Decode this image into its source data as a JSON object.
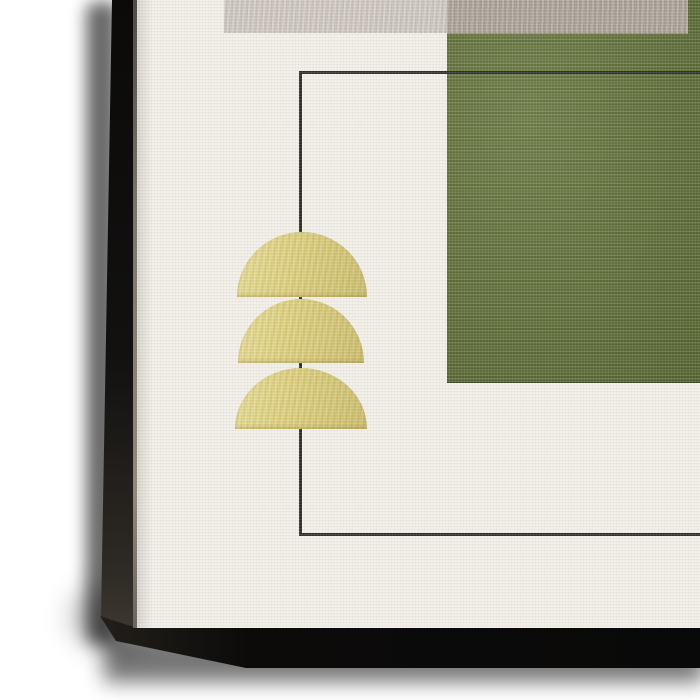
{
  "scene": {
    "type": "canvas-wall-art-corner-closeup",
    "background_color": "#ffffff",
    "canvas": {
      "front_color": "#f2efe9",
      "side_color": "#12100e",
      "texture": "linen"
    },
    "artwork": {
      "style": "abstract geometric",
      "colors": {
        "gray_light": "#cfc9c0",
        "gray_dark": "#aba399",
        "green": "#5c6e32",
        "outline": "#2a2a27",
        "gold": "#dccf7c"
      },
      "elements": {
        "gray_rectangle_light": "top band, left of center",
        "gray_rectangle_dark": "top band, right of center",
        "green_rectangle": "large block, upper right",
        "outline_rectangle": "thin dark rectangle frame line",
        "gold_semicircles_count": 3
      }
    }
  }
}
